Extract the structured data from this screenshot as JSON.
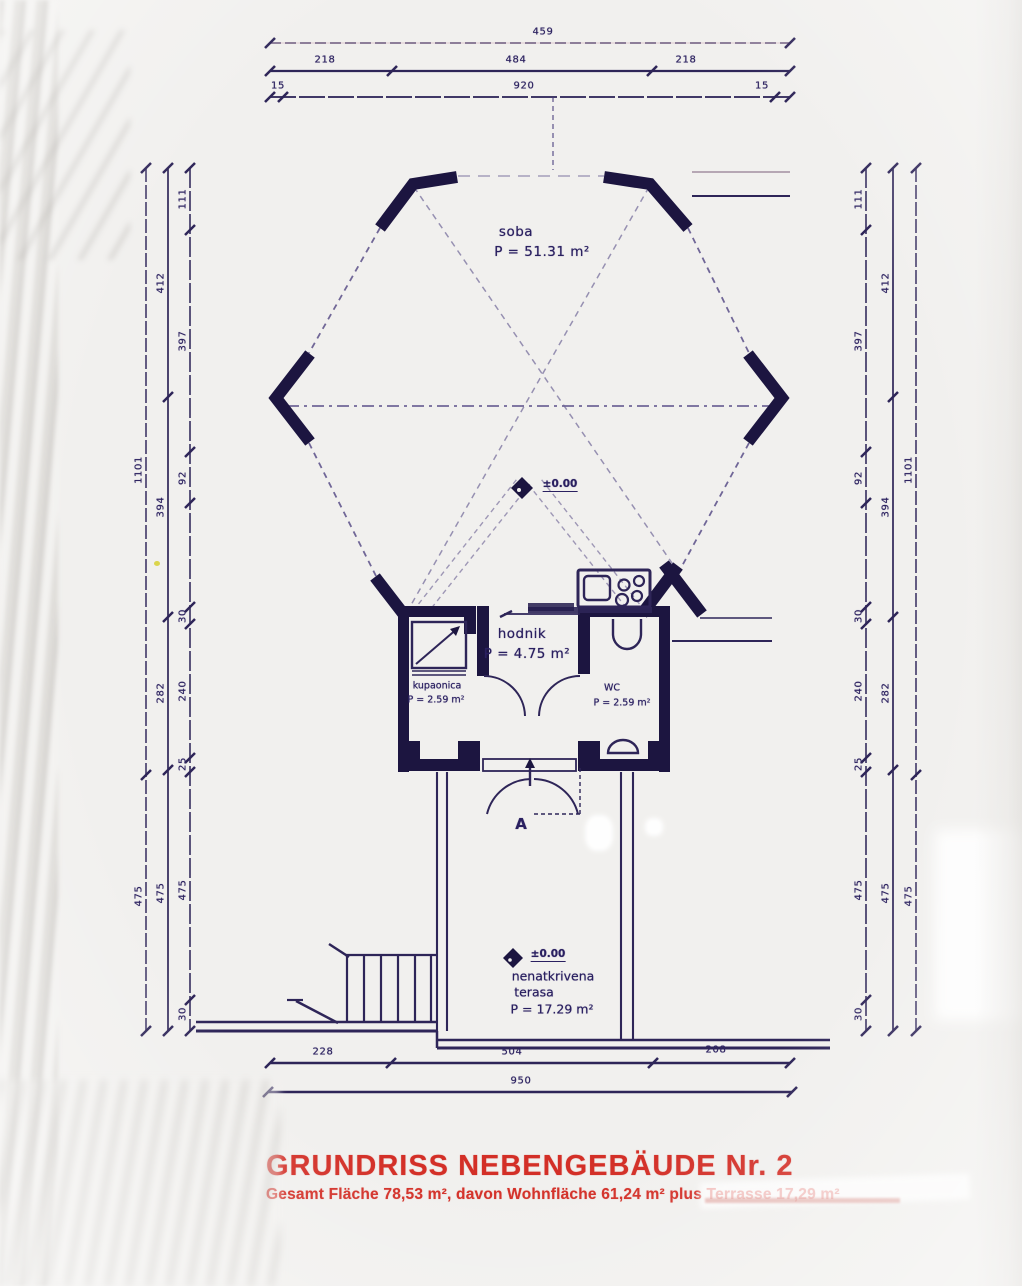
{
  "title": {
    "heading": "GRUNDRISS  NEBENGEBÄUDE Nr.  2",
    "subtitle": "Gesamt  Fläche 78,53 m², davon Wohnfläche 61,24 m² plus Terrasse 17,29 m²"
  },
  "rooms": {
    "soba": {
      "name": "soba",
      "area": "P = 51.31 m²"
    },
    "hodnik": {
      "name": "hodnik",
      "area": "P = 4.75 m²"
    },
    "kupaonica": {
      "name": "kupaonica",
      "area": "P = 2.59 m²"
    },
    "wc": {
      "name": "WC",
      "area": "P = 2.59 m²"
    },
    "terasa": {
      "name1": "nenatkrivena",
      "name2": "terasa",
      "area": "P = 17.29 m²"
    }
  },
  "levels": {
    "main": "±0.00",
    "terrace": "±0.00"
  },
  "door_label": "A",
  "dimensions": {
    "top": {
      "row1": [
        "459"
      ],
      "row2": [
        "218",
        "484",
        "218"
      ],
      "row3": [
        "15",
        "920",
        "15"
      ]
    },
    "bottom": {
      "row1": [
        "228",
        "504",
        "208"
      ],
      "row2": [
        "950"
      ]
    },
    "left": {
      "inner": [
        "111",
        "397",
        "92",
        "30",
        "240",
        "25",
        "475",
        "30"
      ],
      "middle": [
        "412",
        "394",
        "282",
        "475"
      ],
      "outer": [
        "1101",
        "475"
      ]
    },
    "right": {
      "inner": [
        "111",
        "397",
        "92",
        "30",
        "240",
        "25",
        "475",
        "30"
      ],
      "middle": [
        "412",
        "394",
        "282",
        "475"
      ],
      "outer": [
        "1101",
        "475"
      ]
    }
  },
  "colors": {
    "ink": "#241c4e",
    "accent_red": "#d32f27",
    "paper": "#f1f0ee"
  }
}
